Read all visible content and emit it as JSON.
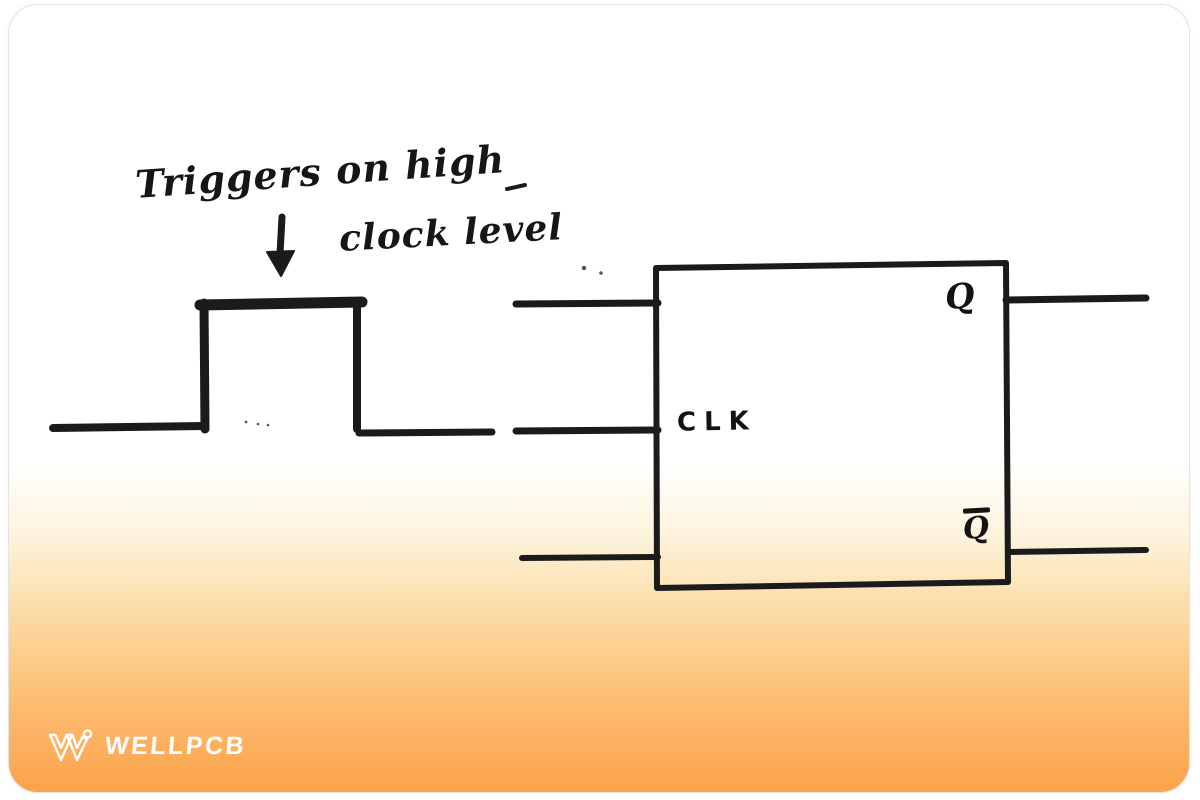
{
  "annotation": {
    "line1": "Triggers on high",
    "line2": "clock level",
    "arrow_icon": "down-arrow"
  },
  "flip_flop": {
    "clk_label": "CLK",
    "q_label": "Q",
    "q_bar_label": "Q"
  },
  "logo": {
    "brand": "WELLPCB",
    "icon": "wellpcb-w-icon"
  },
  "colors": {
    "ink": "#1b1b1b",
    "card_orange_bottom": "#fca24a",
    "card_top": "#ffffff",
    "logo_white": "#ffffff"
  }
}
